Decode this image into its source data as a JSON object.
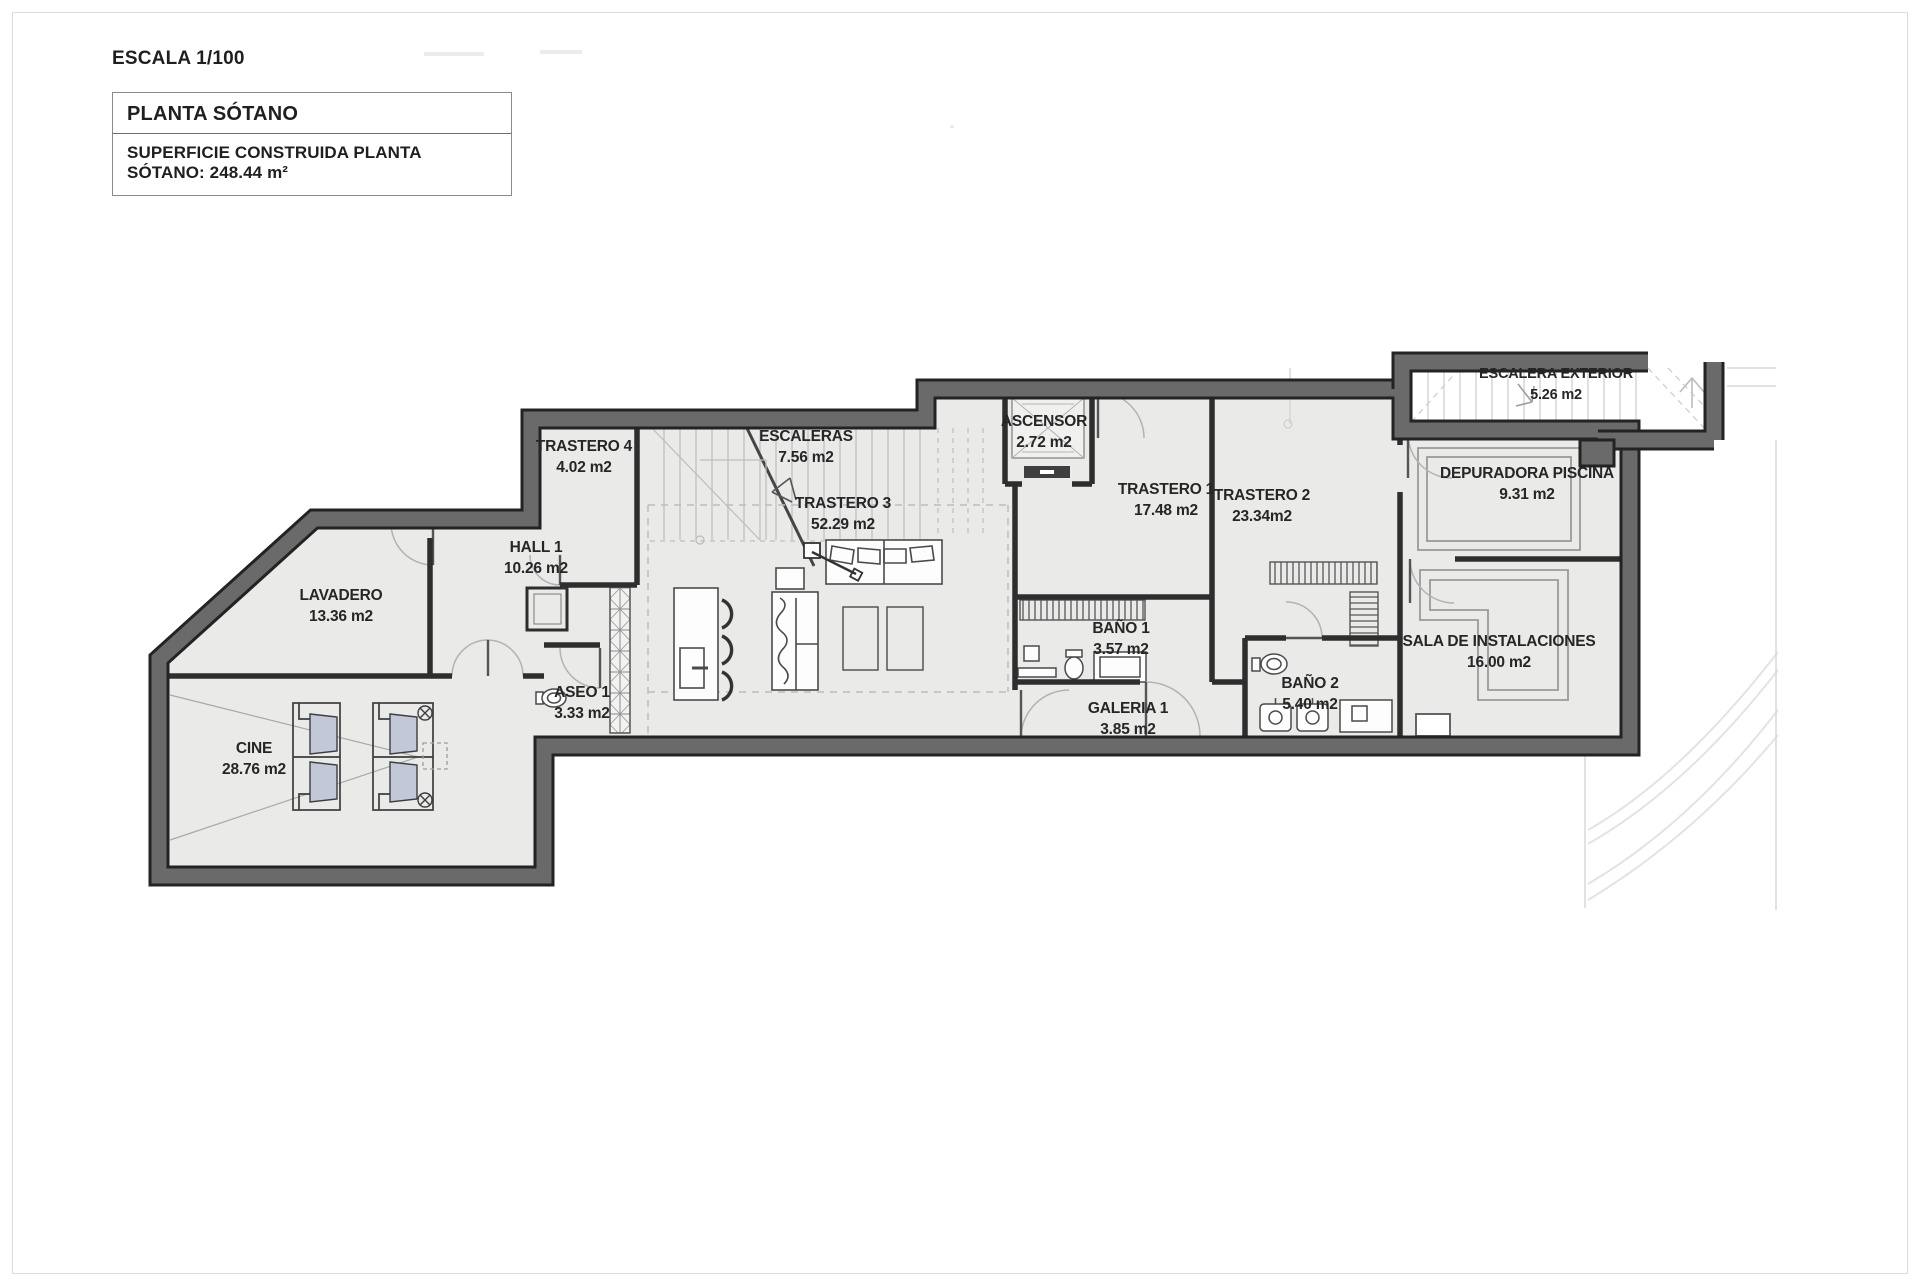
{
  "title_block": {
    "scale": "ESCALA 1/100",
    "floor_title": "PLANTA SÓTANO",
    "area_note": "SUPERFICIE CONSTRUIDA PLANTA SÓTANO: 248.44 m²"
  },
  "plan": {
    "floor_name": "Planta Sótano (basement floor plan)",
    "total_built_area_m2": "248.44",
    "scale": "1/100"
  },
  "rooms": [
    {
      "id": "trastero4",
      "name": "TRASTERO 4",
      "area": "4.02 m2",
      "x": 584,
      "y": 451
    },
    {
      "id": "escaleras",
      "name": "ESCALERAS",
      "area": "7.56 m2",
      "x": 806,
      "y": 441
    },
    {
      "id": "ascensor",
      "name": "ASCENSOR",
      "area": "2.72 m2",
      "x": 1044,
      "y": 426
    },
    {
      "id": "trastero1",
      "name": "TRASTERO 1",
      "area": "17.48 m2",
      "x": 1166,
      "y": 494
    },
    {
      "id": "trastero2",
      "name": "TRASTERO 2",
      "area": "23.34m2",
      "x": 1262,
      "y": 500
    },
    {
      "id": "escalera-exterior",
      "name": "ESCALERA EXTERIOR",
      "area": "5.26 m2",
      "x": 1556,
      "y": 378,
      "fs": 14.5
    },
    {
      "id": "depuradora-piscina",
      "name": "DEPURADORA PISCINA",
      "area": "9.31 m2",
      "x": 1527,
      "y": 478
    },
    {
      "id": "hall1",
      "name": "HALL 1",
      "area": "10.26 m2",
      "x": 536,
      "y": 552
    },
    {
      "id": "trastero3",
      "name": "TRASTERO 3",
      "area": "52.29 m2",
      "x": 843,
      "y": 508
    },
    {
      "id": "lavadero",
      "name": "LAVADERO",
      "area": "13.36 m2",
      "x": 341,
      "y": 600
    },
    {
      "id": "bano1",
      "name": "BAÑO 1",
      "area": "3.57 m2",
      "x": 1121,
      "y": 633
    },
    {
      "id": "sala-instalaciones",
      "name": "SALA DE INSTALACIONES",
      "area": "16.00 m2",
      "x": 1499,
      "y": 646
    },
    {
      "id": "aseo1",
      "name": "ASEO 1",
      "area": "3.33 m2",
      "x": 582,
      "y": 697
    },
    {
      "id": "bano2",
      "name": "BAÑO 2",
      "area": "5.40 m2",
      "x": 1310,
      "y": 688
    },
    {
      "id": "galeria1",
      "name": "GALERIA 1",
      "area": "3.85 m2",
      "x": 1128,
      "y": 713
    },
    {
      "id": "cine",
      "name": "CINE",
      "area": "28.76 m2",
      "x": 254,
      "y": 753
    }
  ],
  "colors": {
    "wall_fill": "#6a6a6a",
    "wall_edge": "#232323",
    "floor": "#eaeae9",
    "label_text": "#262626",
    "door_arc": "#b3b3b3",
    "furniture_line": "#4a4a4a",
    "cushion": "#c2c8d8",
    "faint_line": "#e3e3e3"
  }
}
